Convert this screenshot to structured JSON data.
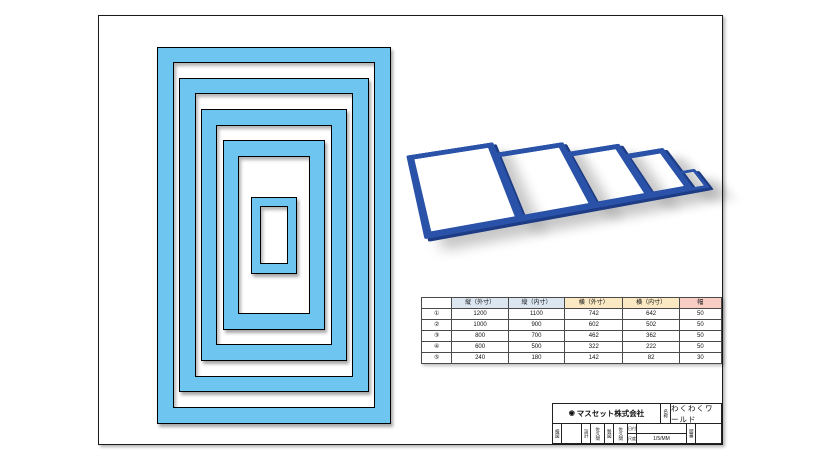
{
  "colors": {
    "frame_fill": "#6EC6F0",
    "frame_outline": "#000000",
    "frame_3d": "#2A52A8",
    "frame_3d_edge": "#1D3C85",
    "header_blue": "#DCE6F1",
    "header_yellow": "#FBE9C4",
    "header_pink": "#F8CDC4"
  },
  "table": {
    "headers": [
      "縦（外寸）",
      "縦（内寸）",
      "横（外寸）",
      "横（内寸）",
      "幅"
    ],
    "header_colors": [
      "#DCE6F1",
      "#DCE6F1",
      "#FBE9C4",
      "#FBE9C4",
      "#F8CDC4"
    ],
    "rows": [
      {
        "label": "①",
        "values": [
          1200,
          1100,
          742,
          642,
          50
        ]
      },
      {
        "label": "②",
        "values": [
          1000,
          900,
          602,
          502,
          50
        ]
      },
      {
        "label": "③",
        "values": [
          800,
          700,
          462,
          362,
          50
        ]
      },
      {
        "label": "④",
        "values": [
          600,
          500,
          322,
          222,
          50
        ]
      },
      {
        "label": "⑤",
        "values": [
          240,
          180,
          142,
          82,
          30
        ]
      }
    ]
  },
  "title_block": {
    "logo_glyph": "◉",
    "company": "マスセット株式会社",
    "name_label": "名称",
    "title": "わくわくワールド",
    "check_label": "検図",
    "design_label": "設計",
    "designer": "佐久間",
    "draft_label": "製図",
    "drafter": "佐久間",
    "date_label": "日付",
    "scale_label": "尺度",
    "scale_value": "1/5/MM",
    "number_label": "図番"
  }
}
